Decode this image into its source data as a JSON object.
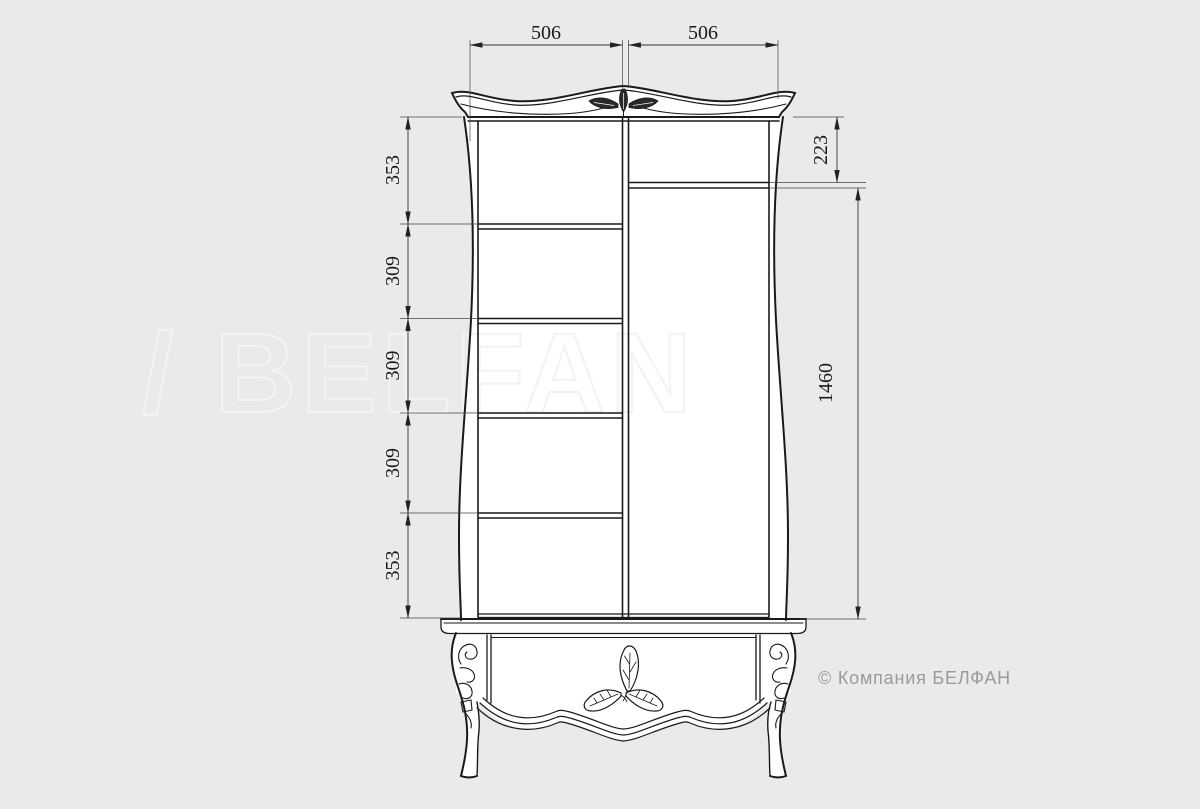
{
  "page": {
    "background_color": "#eaeaea"
  },
  "drawing": {
    "subject": "wardrobe-front-view",
    "line_color": "#1a1a1a",
    "dim_line_color": "#333333",
    "fill_color": "#ffffff"
  },
  "dimensions": {
    "top": [
      "506",
      "506"
    ],
    "left": [
      "353",
      "309",
      "309",
      "309",
      "353"
    ],
    "right": [
      "223",
      "1460"
    ]
  },
  "watermark": {
    "text": "/ BELFAN",
    "stroke_color": "#f3f3f3"
  },
  "copyright": {
    "text": "© Компания БЕЛФАН",
    "color": "#9b9b9b"
  }
}
